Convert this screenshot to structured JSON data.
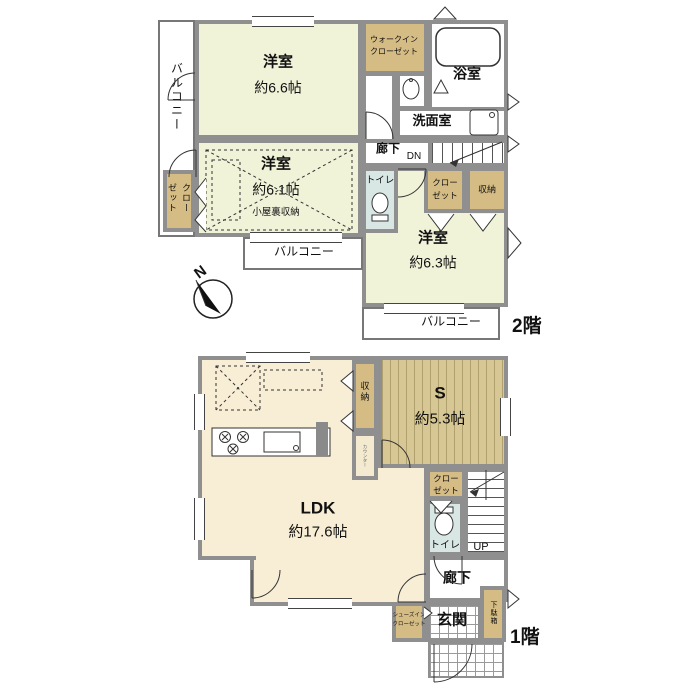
{
  "floor2": {
    "floor_label": "2階",
    "balcony_left": "バルコニー",
    "balcony_mid": "バルコニー",
    "balcony_right": "バルコニー",
    "room_a_name": "洋室",
    "room_a_size": "約6.6帖",
    "wic_line1": "ウォークイン",
    "wic_line2": "クローゼット",
    "bathroom": "浴室",
    "washroom": "洗面室",
    "hallway": "廊下",
    "stairs_dn": "DN",
    "toilet": "トイレ",
    "room_b_name": "洋室",
    "room_b_size": "約6.1帖",
    "attic_storage": "小屋裏収納",
    "closet_left": "クローゼット",
    "closet_right_line1": "クロー",
    "closet_right_line2": "ゼット",
    "storage": "収納",
    "room_c_name": "洋室",
    "room_c_size": "約6.3帖"
  },
  "floor1": {
    "floor_label": "1階",
    "ldk_name": "LDK",
    "ldk_size": "約17.6帖",
    "storage": "収納",
    "counter": "カウンター",
    "s_room_name": "S",
    "s_room_size": "約5.3帖",
    "closet_line1": "クロー",
    "closet_line2": "ゼット",
    "toilet": "トイレ",
    "stairs_up": "UP",
    "hallway": "廊下",
    "shoe_box": "下駄箱",
    "entrance": "玄関",
    "sic_line1": "シューズイン",
    "sic_line2": "クローゼット"
  },
  "compass": {
    "north": "N"
  },
  "colors": {
    "wall": "#8f8f8f",
    "room_floor": "#f1f3d9",
    "ldk_floor": "#f8eed6",
    "closet_tan": "#d5bc85",
    "s_room_tan": "#d6c794",
    "toilet_blue": "#d8e7e4"
  }
}
